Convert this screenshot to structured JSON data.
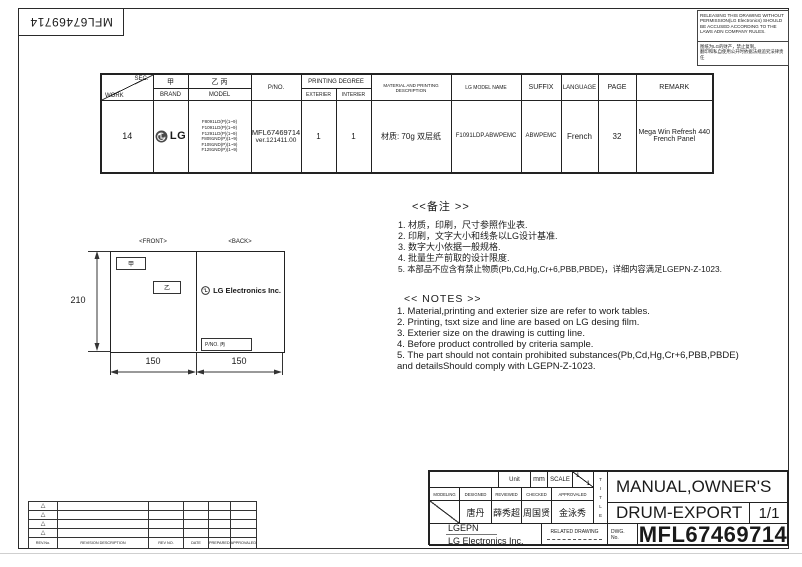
{
  "stamp": {
    "doc_no": "MFL67469714"
  },
  "warning": {
    "en": "RELEASING THIS DRAWING WITHOUT PERMISSION(LG Electronics) SHOULD BE ACCUSED ACCORDING TO THE LAWS ADN COMPANY RULES.",
    "cn_line1": "图纸为LG的财产，禁止复制。",
    "cn_line2": "翻印和私自使用公开时依据法规追究法律责任"
  },
  "work_table": {
    "sec_label": "SEC.",
    "work_label": "WORK",
    "brand_cn": "甲",
    "brand_label": "BRAND",
    "model_cn": "乙 丙",
    "model_label": "MODEL",
    "pno_label": "P/NO.",
    "printing_degree_label": "PRINTING DEGREE",
    "exterier_label": "EXTERIER",
    "interier_label": "INTERIER",
    "material_label": "MATERIAL AND PRINTING DESCRIPTION",
    "lg_model_label": "LG MODEL NAME",
    "suffix_label": "SUFFIX",
    "language_label": "LANGUAGE",
    "page_label": "PAGE",
    "remark_label": "REMARK",
    "row": {
      "work": "14",
      "brand": "LG",
      "models": [
        "F8091LD(P)(1~9)",
        "F1091LD(P)(1~9)",
        "F1291LD(P)(1~9)",
        "F8091ND(P)(1~9)",
        "F1091ND(P)(1~9)",
        "F1291ND(P)(1~9)"
      ],
      "pno_line1": "MFL67469714",
      "pno_line2": "ver.121411.00",
      "exterier": "1",
      "interier": "1",
      "material": "材质: 70g 双层纸",
      "lg_model_name": "F1091LDP.ABWPEMC",
      "suffix": "ABWPEMC",
      "language": "French",
      "page": "32",
      "remark_line1": "Mega  Win Refresh 440",
      "remark_line2": "French   Panel"
    }
  },
  "drawing": {
    "front_label": "<FRONT>",
    "back_label": "<BACK>",
    "brand_box": "甲",
    "model_box": "乙",
    "logo_text": "LG Electronics Inc.",
    "pno_box": "P/NO. 丙",
    "dim_height": "210",
    "dim_front_width": "150",
    "dim_back_width": "150"
  },
  "notes_cn": {
    "title": "<<备注 >>",
    "items": [
      "1.  材质，印刷，尺寸参照作业表.",
      "2.  印刷，文字大小和线条以LG设计基准.",
      "3.  数字大小依据一般规格.",
      "4.  批量生产前取的设计限度.",
      "5.  本部品不应含有禁止物质(Pb,Cd,Hg,Cr+6,PBB,PBDE)，详细内容满足LGEPN-Z-1023."
    ]
  },
  "notes_en": {
    "title": "<< NOTES >>",
    "items": [
      "1. Material,printing and exterier size are refer to work tables.",
      "2. Printing, tsxt  size and line are based on LG desing film.",
      "3. Exterier size on the drawing is cutting line.",
      "4. Before product controlled by criteria sample.",
      "5. The part should not contain prohibited substances(Pb,Cd,Hg,Cr+6,PBB,PBDE)",
      "    and detailsShould comply with LGEPN-Z-1023."
    ]
  },
  "revision_table": {
    "marker": "△",
    "rev_no_label": "REV.No.",
    "description_label": "REVISION DESCRIPTION",
    "rev_no2_label": "REV NO.",
    "date_label": "DATE",
    "prepared_label": "PREPARED",
    "approved_label": "APPROVALED"
  },
  "title_block": {
    "unit_label": "Unit",
    "unit_value": "mm",
    "scale_label": "SCALE",
    "scale_num": "1",
    "scale_den": "1",
    "modeling_label": "MODELING",
    "designed_label": "DESIGNED",
    "reviewed_label": "REVIEWED",
    "checked_label": "CHECKED",
    "approved_label": "APPROVALED",
    "designed_name": "唐丹",
    "reviewed_name": "薛秀超",
    "checked_name": "周国贤",
    "approved_name": "金泳秀",
    "company_short": "LGEPN",
    "company_full": "LG Electronics Inc.",
    "related_drawing_label": "RELATED DRAWING",
    "dwg_label_1": "DWG.",
    "dwg_label_2": "No.",
    "title_vertical": [
      "T",
      "I",
      "T",
      "L",
      "E"
    ],
    "title_line1": "MANUAL,OWNER'S",
    "title_line2": "DRUM-EXPORT",
    "sheet": "1/1",
    "dwg_no": "MFL67469714"
  }
}
